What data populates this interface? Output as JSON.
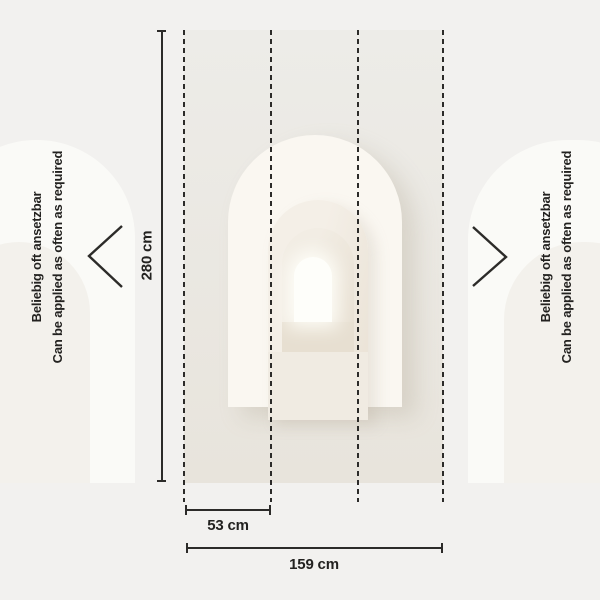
{
  "notes": {
    "de": "Beliebig oft ansetzbar",
    "en": "Can be applied as often as required"
  },
  "dimensions": {
    "height": {
      "label": "280 cm",
      "value_cm": 280
    },
    "panel_width": {
      "label": "53 cm",
      "value_cm": 53
    },
    "total_width": {
      "label": "159 cm",
      "value_cm": 159
    }
  },
  "panels": {
    "seam_count": 4,
    "panel_count": 3
  },
  "colors": {
    "canvas_bg": "#f2f1ef",
    "line": "#2c2b29",
    "text": "#232220",
    "mural_top": "#edece8",
    "mural_bottom": "#e8e4dc",
    "arch_cream": "#faf7f1",
    "arch_mid": "#f4efe7",
    "arch_inner_dark": "#e3d9c9",
    "window_white": "#fefefa"
  }
}
